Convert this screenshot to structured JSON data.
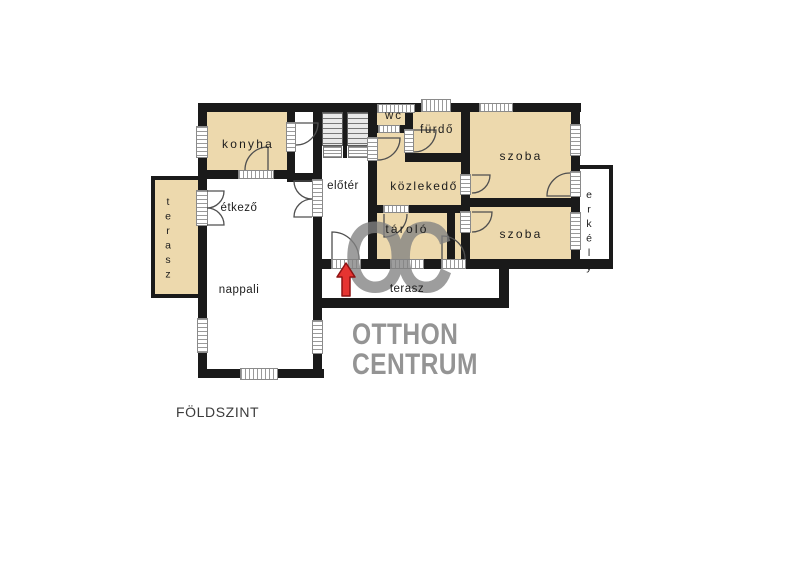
{
  "floor": {
    "label": "FÖLDSZINT"
  },
  "rooms": {
    "konyha": "konyha",
    "etkezo": "étkező",
    "nappali": "nappali",
    "terasz_left": "terasz",
    "eloter": "előtér",
    "wc": "wc",
    "furdo": "fürdő",
    "kozlekedo": "közlekedő",
    "tarolo": "tároló",
    "szoba1": "szoba",
    "szoba2": "szoba",
    "erkely": "erkély",
    "terasz_bottom": "terasz"
  },
  "watermark": {
    "monogram": "OC",
    "line1": "OTTHON",
    "line2": "CENTRUM"
  },
  "colors": {
    "room_fill": "#edd9ad",
    "wall": "#1a1a1a",
    "watermark": "#828282",
    "arrow": "#e63431",
    "arrow_outline": "#8e1212"
  }
}
